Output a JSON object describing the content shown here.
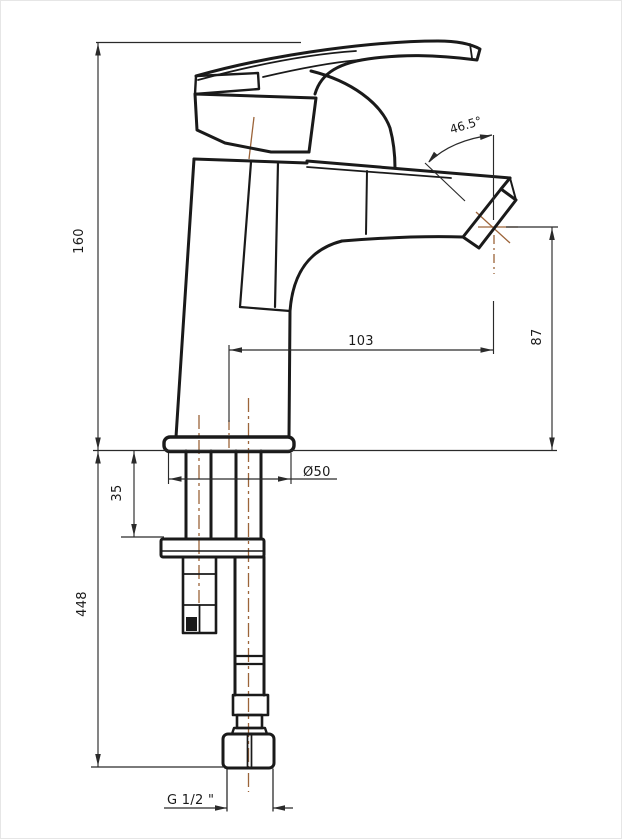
{
  "drawing": {
    "kind": "technical-dimension-drawing",
    "subject": "single-lever-basin-mixer-side-view",
    "units": "mm",
    "colors": {
      "outline": "#1a1a1a",
      "dimension": "#2a2a2a",
      "centerline": "#9c6439",
      "background": "#ffffff"
    },
    "dimensions": {
      "body_height": "160",
      "below_deck_length": "448",
      "deck_clamp_thickness": "35",
      "base_diameter": "Ø50",
      "spout_reach": "103",
      "outlet_height": "87",
      "spout_angle": "46.5°",
      "inlet_thread": "G 1/2 \""
    }
  }
}
